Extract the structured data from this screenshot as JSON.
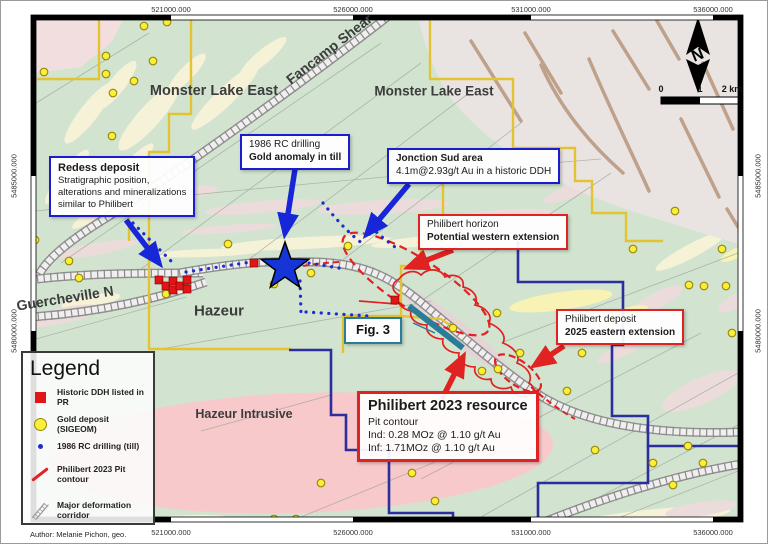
{
  "frame": {
    "top": [
      "521000.000",
      "526000.000",
      "531000.000",
      "536000.000"
    ],
    "bottom": [
      "521000.000",
      "526000.000",
      "531000.000",
      "536000.000"
    ],
    "left": [
      "5485000.000",
      "5480000.000"
    ],
    "right": [
      "5485000.000",
      "5480000.000"
    ]
  },
  "labels": {
    "monster_west": "Monster Lake East",
    "monster_east": "Monster Lake East",
    "fancamp": "Fancamp Shear",
    "guercheville": "Guercheville N",
    "hazeur": "Hazeur",
    "hazeur_intrusive": "Hazeur Intrusive"
  },
  "callouts": {
    "redess": {
      "title": "Redess deposit",
      "line1": "Stratigraphic position,",
      "line2": "alterations and mineralizations",
      "line3": "similar to Philibert"
    },
    "rc1986": {
      "line1": "1986 RC drilling",
      "line2": "Gold anomaly in till"
    },
    "jonction": {
      "title": "Jonction Sud area",
      "line1": "4.1m@2.93g/t Au in a historic DDH"
    },
    "horizon": {
      "line1": "Philibert horizon",
      "line2": "Potential western extension"
    },
    "deposit": {
      "line1": "Philibert deposit",
      "line2": "2025 eastern extension"
    },
    "fig3": {
      "label": "Fig. 3"
    },
    "resource": {
      "title": "Philibert 2023 resource",
      "line1": "Pit contour",
      "line2": "Ind: 0.28 MOz @ 1.10 g/t Au",
      "line3": "Inf: 1.71MOz @ 1.10 g/t Au"
    }
  },
  "legend": {
    "title": "Legend",
    "items": [
      {
        "symbol": "red-square",
        "label": "Historic DDH listed in PR"
      },
      {
        "symbol": "yellow-circle",
        "label": "Gold deposit (SIGEOM)"
      },
      {
        "symbol": "blue-dot",
        "label": "1986 RC drilling (till)"
      },
      {
        "symbol": "red-line",
        "label": "Philibert 2023 Pit contour"
      },
      {
        "symbol": "hatched-corridor",
        "label": "Major deformation corridor"
      }
    ],
    "author": "Author: Melanie Pichon, geo."
  },
  "north_label": "N",
  "scalebar": {
    "t0": "0",
    "t1": "1",
    "t2": "2 km"
  },
  "colors": {
    "callout_blue": "#1b1bd0",
    "callout_red": "#e02222",
    "fig3_teal": "#2a7d96",
    "claim_yellow": "#e3c331",
    "claim_navy": "#2b2f9e",
    "star_blue": "#1535d6",
    "gold_dot": "#f9ef39",
    "map_green": "#d2e4d0",
    "intrusive_pink": "#f7c9ca"
  }
}
